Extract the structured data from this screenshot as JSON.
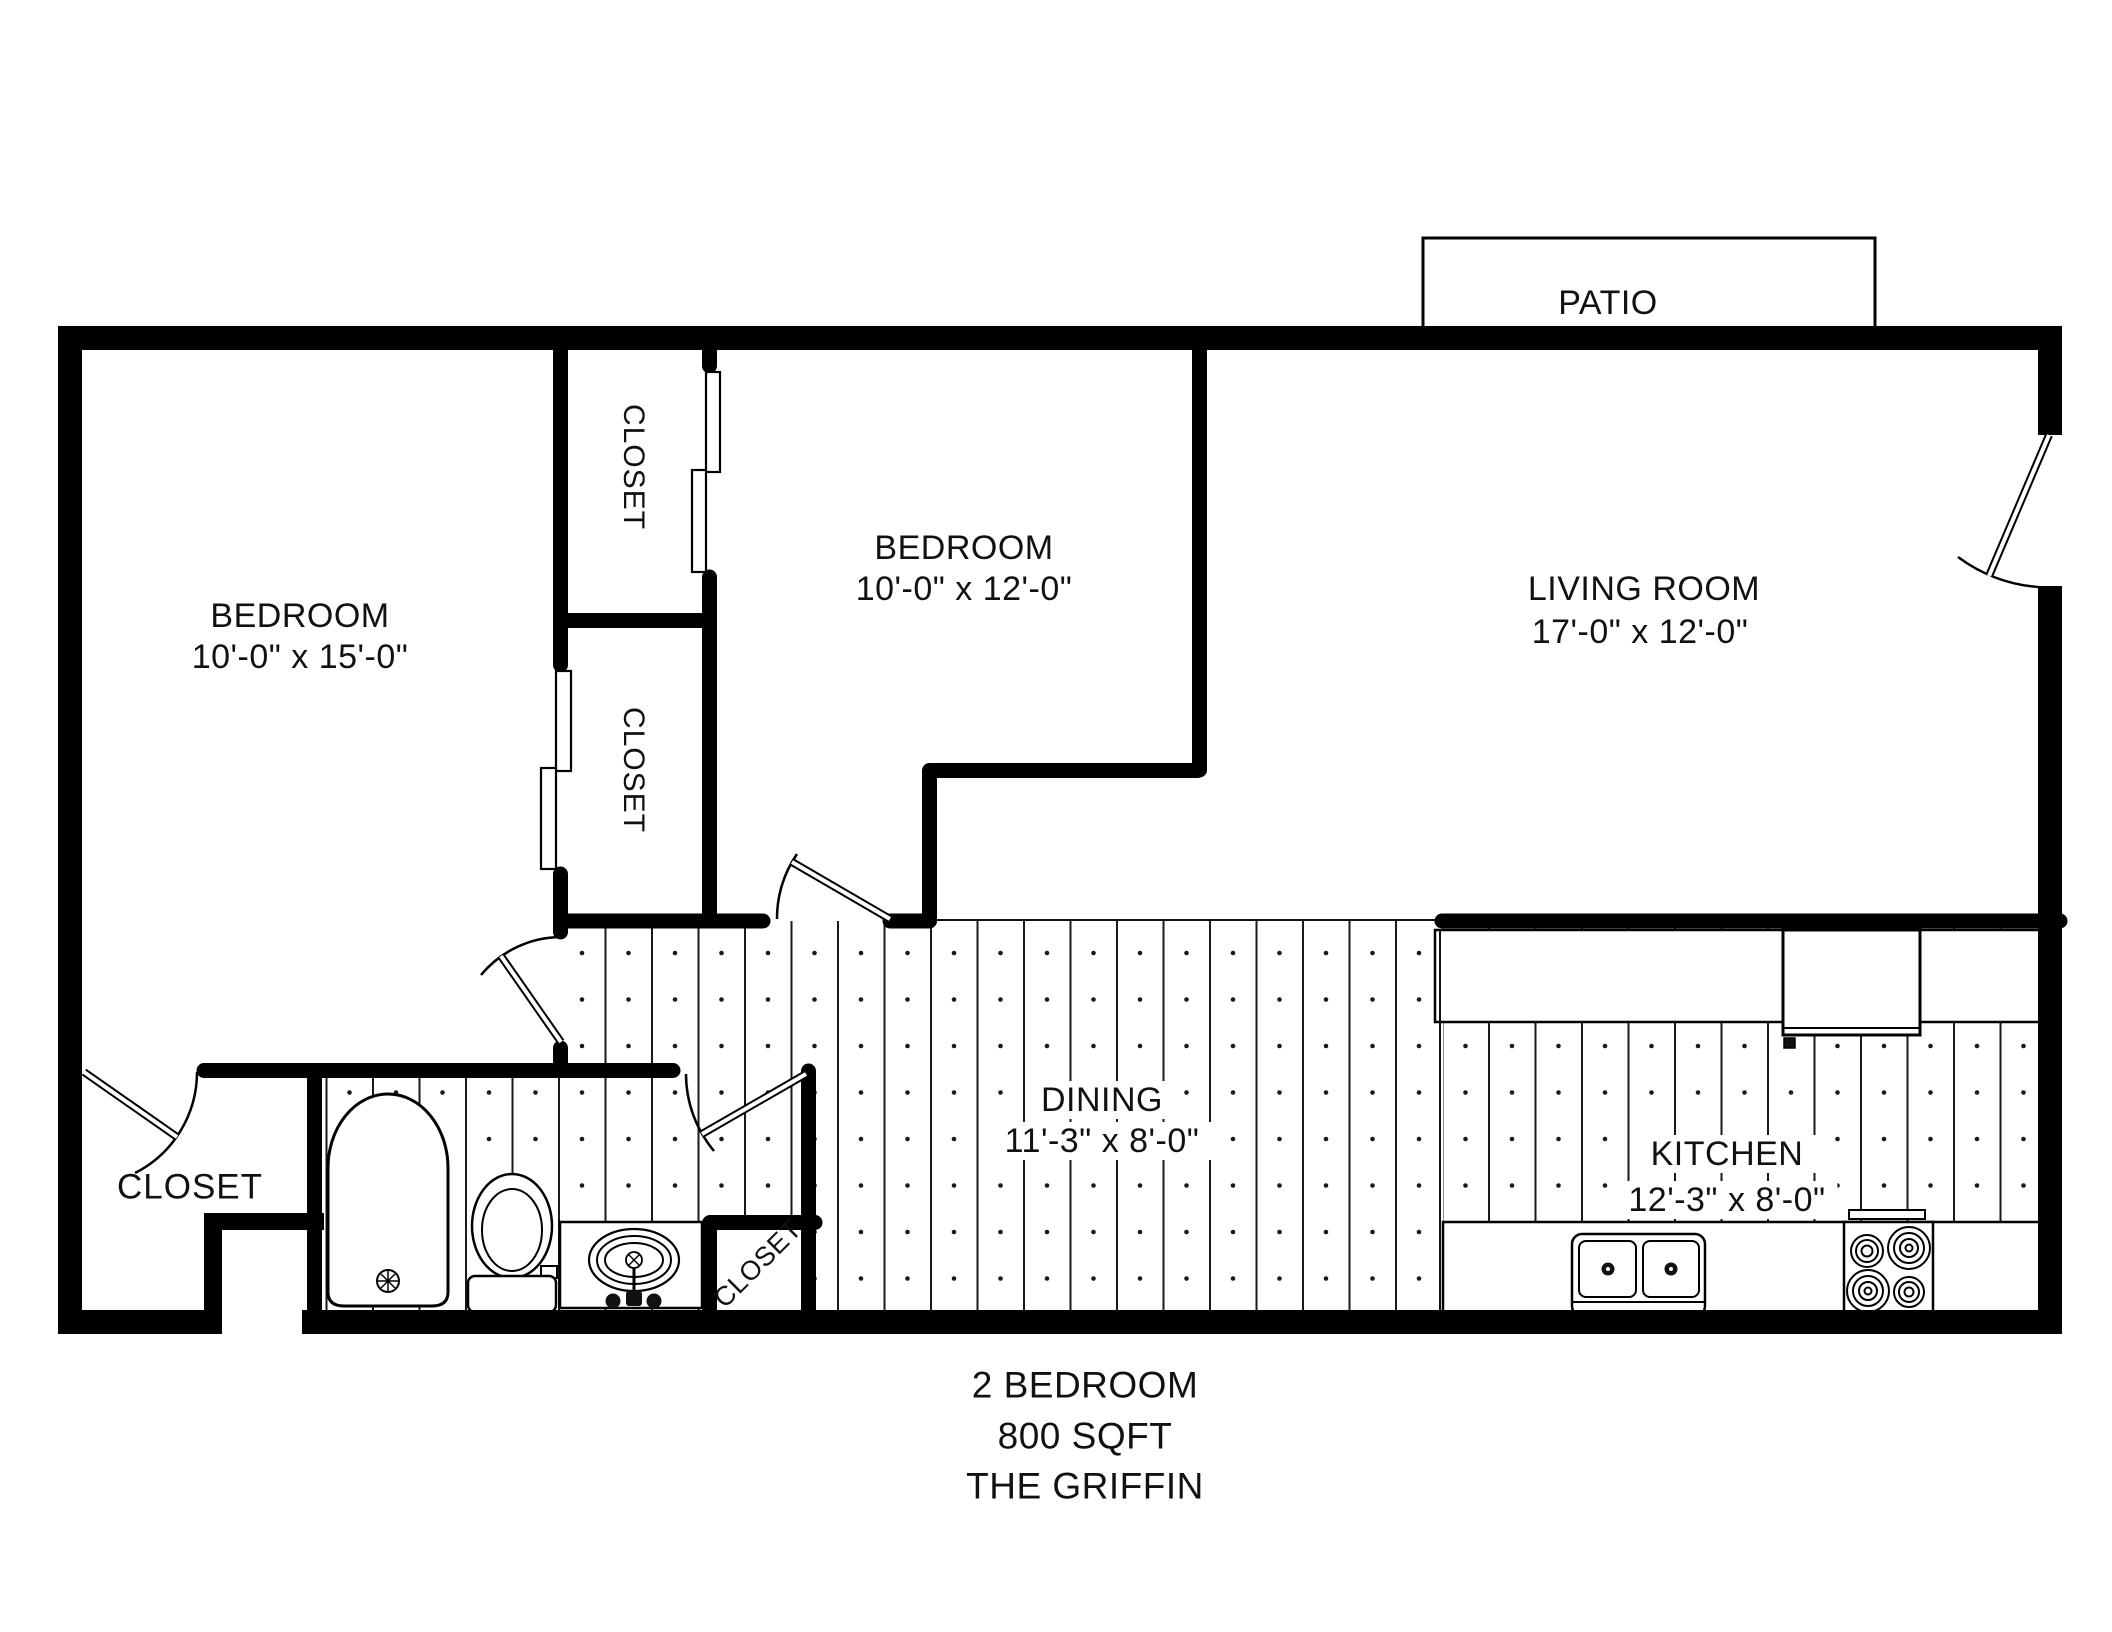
{
  "plan": {
    "patio": "PATIO",
    "rooms": {
      "bedroom1": {
        "label": "BEDROOM",
        "dims": "10'-0\" x 15'-0\""
      },
      "bedroom2": {
        "label": "BEDROOM",
        "dims": "10'-0\" x 12'-0\""
      },
      "living": {
        "label": "LIVING ROOM",
        "dims": "17'-0\" x 12'-0\""
      },
      "dining": {
        "label": "DINING",
        "dims": "11'-3\" x 8'-0\""
      },
      "kitchen": {
        "label": "KITCHEN",
        "dims": "12'-3\" x 8'-0\""
      }
    },
    "closets": {
      "top": "CLOSET",
      "middle": "CLOSET",
      "entry": "CLOSET",
      "bath": "CLOSET"
    },
    "footer": {
      "line1": "2 BEDROOM",
      "line2": "800 SQFT",
      "line3": "THE GRIFFIN"
    },
    "colors": {
      "wall": "#000000",
      "line": "#111111",
      "background": "#ffffff"
    }
  }
}
